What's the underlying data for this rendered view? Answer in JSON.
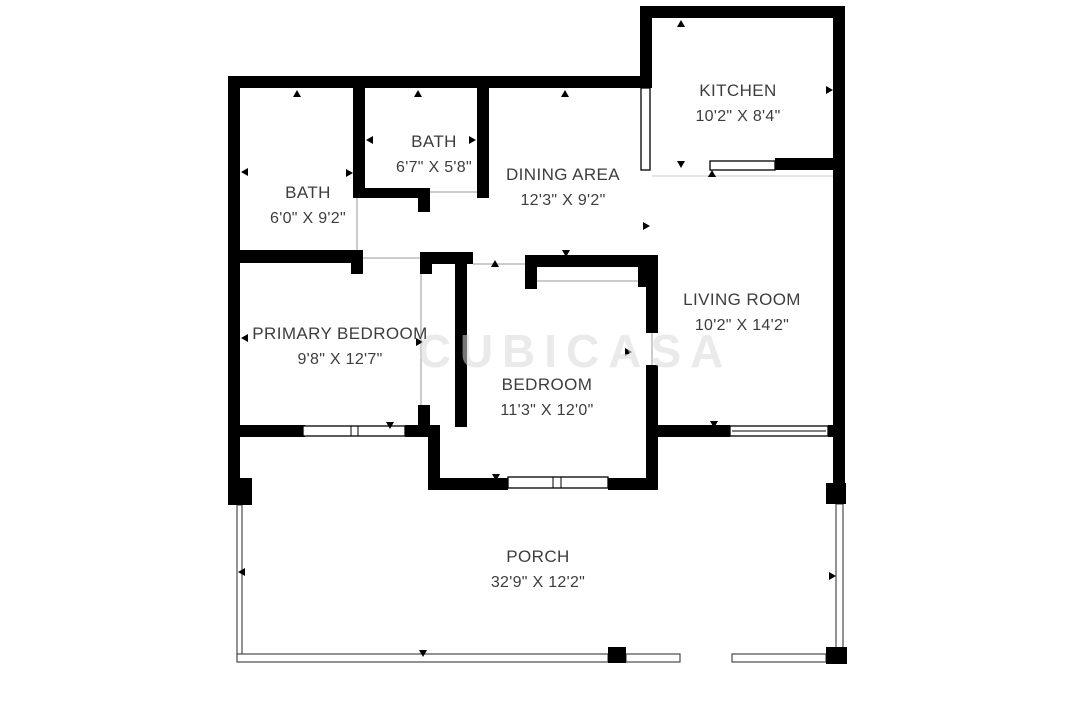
{
  "title": "Floor plan",
  "colors": {
    "wall": "#000000",
    "label": "#3d3d3d",
    "background": "#ffffff",
    "watermark": "#d9d9d9"
  },
  "watermark": {
    "text": "CUBICASA"
  },
  "rooms": [
    {
      "id": "kitchen",
      "name": "KITCHEN",
      "dimensions": "10'2\" X 8'4\""
    },
    {
      "id": "bath-small",
      "name": "BATH",
      "dimensions": "6'7\" X 5'8\""
    },
    {
      "id": "dining-area",
      "name": "DINING AREA",
      "dimensions": "12'3\" X 9'2\""
    },
    {
      "id": "bath",
      "name": "BATH",
      "dimensions": "6'0\" X 9'2\""
    },
    {
      "id": "living-room",
      "name": "LIVING ROOM",
      "dimensions": "10'2\" X 14'2\""
    },
    {
      "id": "primary-bedroom",
      "name": "PRIMARY BEDROOM",
      "dimensions": "9'8\" X 12'7\""
    },
    {
      "id": "bedroom",
      "name": "BEDROOM",
      "dimensions": "11'3\" X 12'0\""
    },
    {
      "id": "porch",
      "name": "PORCH",
      "dimensions": "32'9\" X 12'2\""
    }
  ]
}
